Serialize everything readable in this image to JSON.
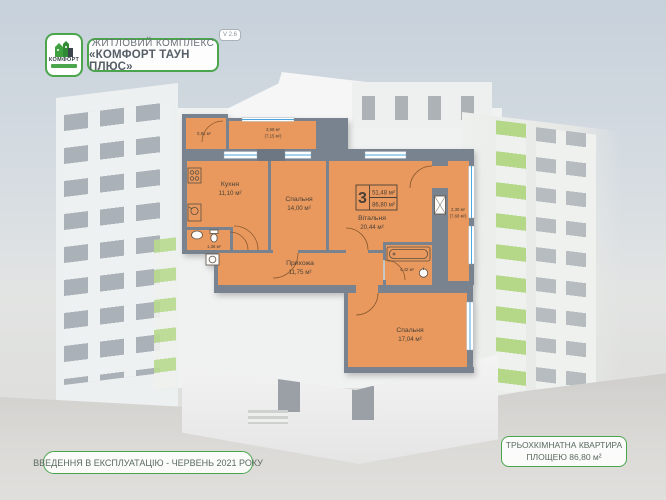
{
  "theme": {
    "green": "#4aa54c",
    "orange": "#e9995e",
    "wall": "#79828f",
    "wall_dark": "#6d7683",
    "window_blue": "#4aa7de",
    "label": "#4a4036",
    "banner_text": "#5a6b5e",
    "title_text": "#565e66"
  },
  "header": {
    "logo_text": "КОМФОРТ",
    "title_line1": "ЖИТЛОВИЙ КОМПЛЕКС",
    "title_line2": "«КОМФОРТ ТАУН ПЛЮС»",
    "version": "V 2.6"
  },
  "floorplan": {
    "badge": {
      "rooms_count": "3",
      "area_living": "51,48 м²",
      "area_total": "86,80 м²"
    },
    "rooms": {
      "storage": {
        "area": "0,81 м²"
      },
      "balcony_top": {
        "area": "3,58 м²",
        "area_alt": "(7,15 м²)"
      },
      "kitchen": {
        "name": "Кухня",
        "area": "11,10 м²"
      },
      "bedroom1": {
        "name": "Спальня",
        "area": "14,00 м²"
      },
      "living": {
        "name": "Вітальня",
        "area": "20,44 м²"
      },
      "balcony_right": {
        "area": "2,30 м²",
        "area_alt": "(7,68 м²)"
      },
      "wc": {
        "area": "1,36 м²"
      },
      "hallway": {
        "name": "Прихожа",
        "area": "11,75 м²"
      },
      "bathroom": {
        "area": "4,42 м²"
      },
      "bedroom2": {
        "name": "Спальня",
        "area": "17,04 м²"
      }
    }
  },
  "footer": {
    "left_banner": "ВВЕДЕННЯ В ЕКСПЛУАТАЦІЮ - ЧЕРВЕНЬ 2021 РОКУ",
    "right_banner_line1": "ТРЬОХКІМНАТНА КВАРТИРА",
    "right_banner_line2": "ПЛОЩЕЮ 86,80 м²"
  }
}
